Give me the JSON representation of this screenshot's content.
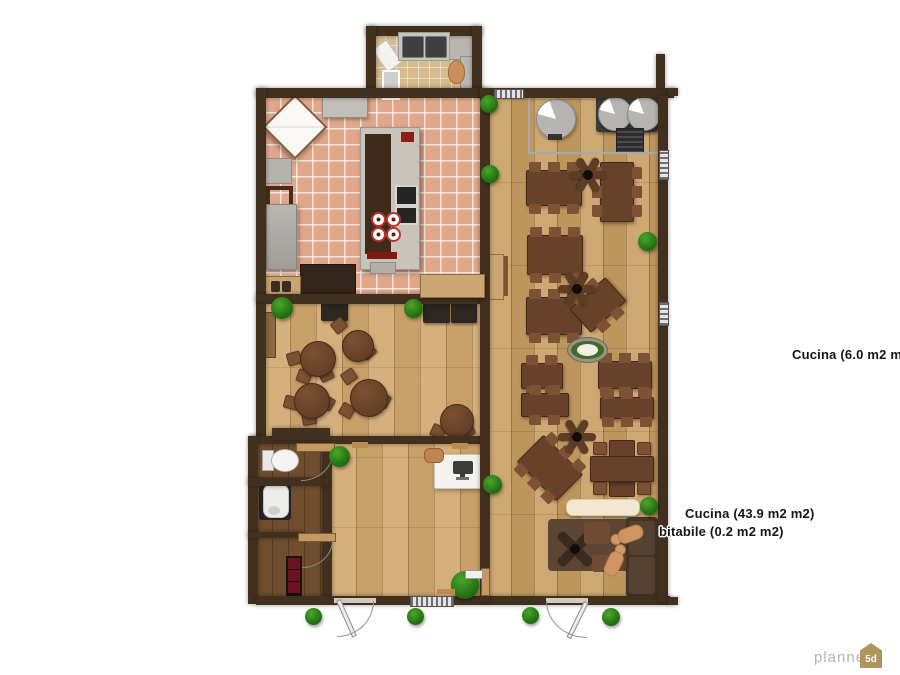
{
  "room_labels": [
    {
      "text": "Cucina (6.0 m2 m2)"
    },
    {
      "text": "Cucina (43.9 m2 m2)"
    },
    {
      "text": "bitabile (0.2 m2 m2)"
    }
  ],
  "watermark": {
    "brand": "planner",
    "badge": "5d"
  },
  "palette": {
    "wall": "#42301f",
    "wood_floor": "#c79e63",
    "kitchen_tile": "#e2a78b",
    "bath_tile": "#d6bc8c",
    "table_wood": "#66422a",
    "plant_green": "#2f8b1d",
    "label_text": "#161616",
    "logo_text": "#b5b3b0",
    "logo_badge": "#b1945c"
  }
}
